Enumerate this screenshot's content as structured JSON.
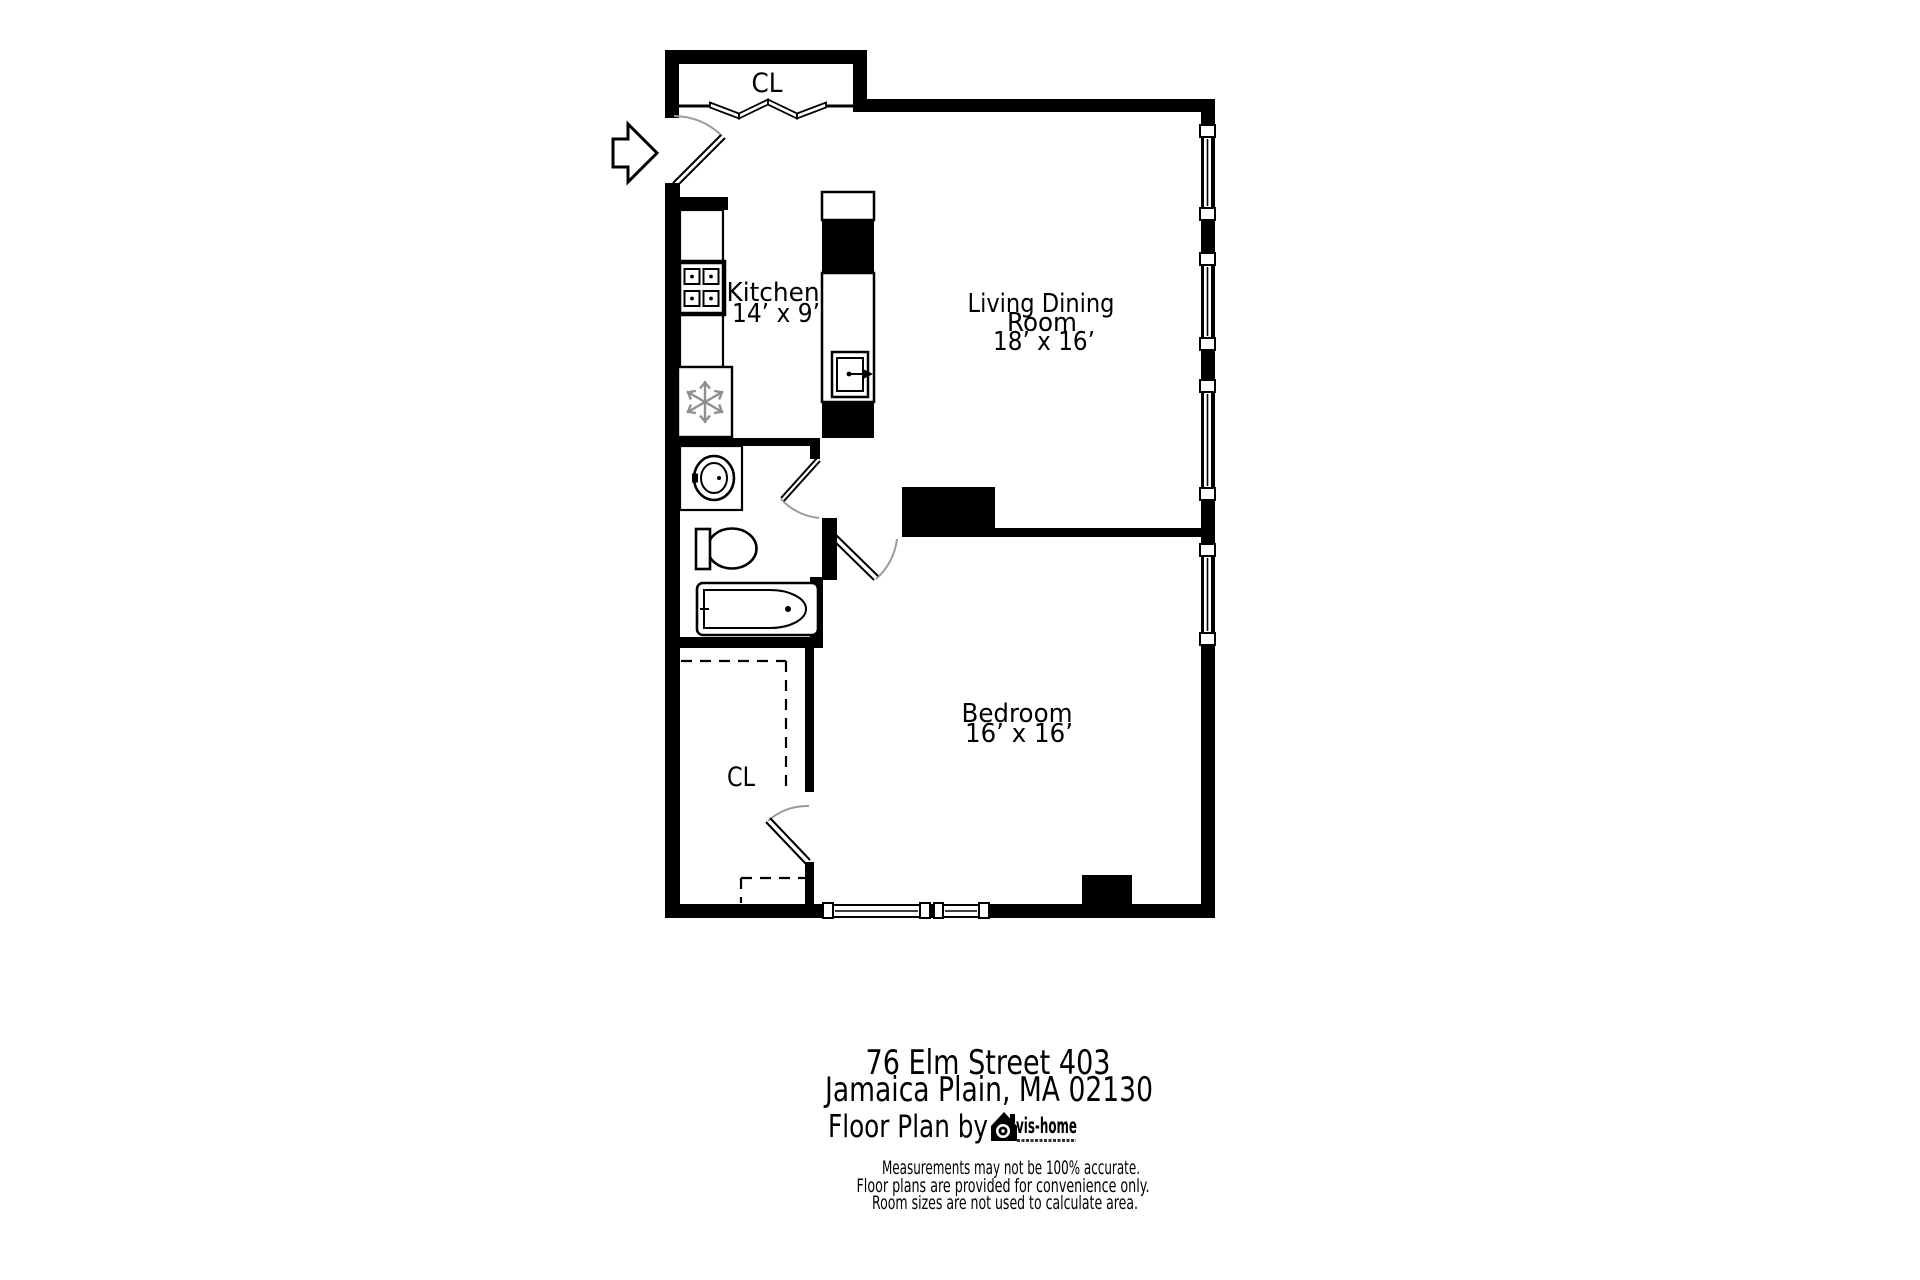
{
  "colors": {
    "wall": "#000000",
    "door_arc": "#9b9b9b",
    "snowflake": "#8f8f8f",
    "background": "#ffffff"
  },
  "floor_plan": {
    "entry_closet_label": "CL",
    "kitchen_label": "Kitchen",
    "kitchen_dimensions": "14’ x 9’",
    "living_dining_label_line1": "Living Dining",
    "living_dining_label_line2": "Room",
    "living_dining_dimensions": "18’ x 16’",
    "bedroom_label": "Bedroom",
    "bedroom_dimensions": "16’ x 16’",
    "bedroom_closet_label": "CL"
  },
  "footer": {
    "address_line1": "76 Elm Street 403",
    "address_line2": "Jamaica Plain, MA 02130",
    "credit_prefix": "Floor Plan by",
    "brand_name": "vis-home",
    "disclaimer_line1": "Measurements may not be 100% accurate.",
    "disclaimer_line2": "Floor plans are provided for convenience only.",
    "disclaimer_line3": "Room sizes are not used to calculate area."
  }
}
